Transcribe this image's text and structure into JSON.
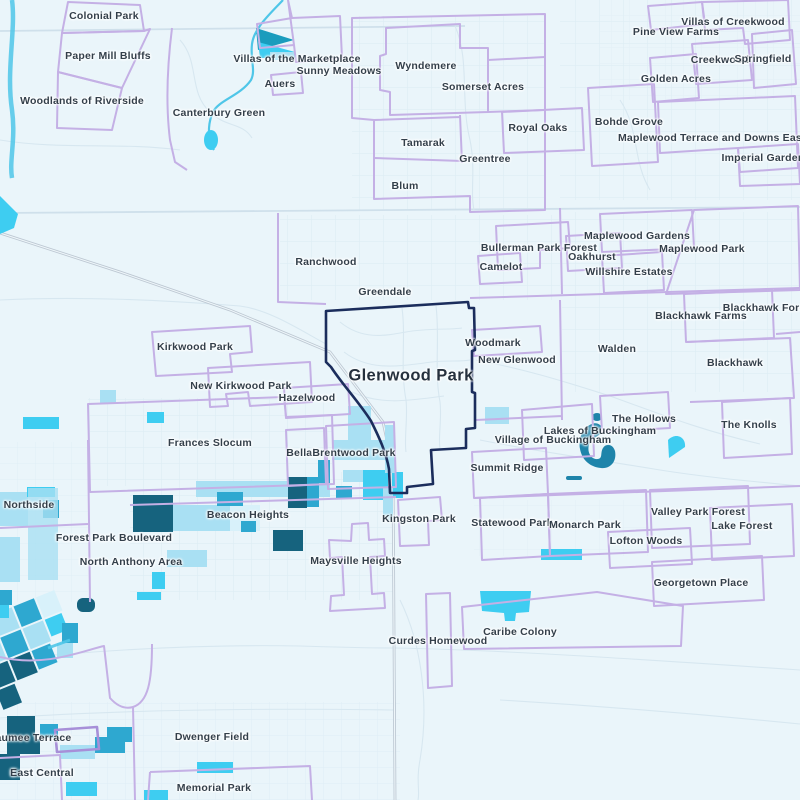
{
  "map": {
    "type": "neighborhood-boundary-map",
    "highlighted_neighborhood": "Glenwood Park",
    "palette": {
      "bg": "#eaf5fa",
      "boundary": "#c4b0e5",
      "boundaryStrong": "#a78fd8",
      "selected": "#1b2d5c",
      "c1": "#d8f1fa",
      "c2": "#a9e0f3",
      "c3": "#2ea8d0",
      "c4": "#3ecdf1",
      "c5": "#16637e",
      "lake": "#1e84aa",
      "river": "#4fc6e8"
    },
    "labels": [
      {
        "text": "Colonial Park",
        "x": 104,
        "y": 16
      },
      {
        "text": "Paper Mill Bluffs",
        "x": 108,
        "y": 56
      },
      {
        "text": "Woodlands of Riverside",
        "x": 82,
        "y": 101
      },
      {
        "text": "Canterbury Green",
        "x": 219,
        "y": 113
      },
      {
        "text": "Villas of the Marketplace",
        "x": 297,
        "y": 59
      },
      {
        "text": "Sunny Meadows",
        "x": 339,
        "y": 71
      },
      {
        "text": "Auers",
        "x": 280,
        "y": 84
      },
      {
        "text": "Wyndemere",
        "x": 426,
        "y": 66
      },
      {
        "text": "Somerset Acres",
        "x": 483,
        "y": 87
      },
      {
        "text": "Royal Oaks",
        "x": 538,
        "y": 128
      },
      {
        "text": "Tamarak",
        "x": 423,
        "y": 143
      },
      {
        "text": "Greentree",
        "x": 485,
        "y": 159
      },
      {
        "text": "Blum",
        "x": 405,
        "y": 186
      },
      {
        "text": "Pine View Farms",
        "x": 676,
        "y": 32
      },
      {
        "text": "Villas of Creekwood",
        "x": 733,
        "y": 22
      },
      {
        "text": "Creekwood",
        "x": 720,
        "y": 60
      },
      {
        "text": "Springfield",
        "x": 763,
        "y": 59
      },
      {
        "text": "Golden Acres",
        "x": 676,
        "y": 79
      },
      {
        "text": "Bohde Grove",
        "x": 629,
        "y": 122
      },
      {
        "text": "Maplewood Terrace and Downs Eastgate",
        "x": 723,
        "y": 138
      },
      {
        "text": "Imperial Gardens",
        "x": 766,
        "y": 158
      },
      {
        "text": "Maplewood Gardens",
        "x": 637,
        "y": 236
      },
      {
        "text": "Maplewood Park",
        "x": 702,
        "y": 249
      },
      {
        "text": "Bullerman Park Forest",
        "x": 539,
        "y": 248
      },
      {
        "text": "Oakhurst",
        "x": 592,
        "y": 257
      },
      {
        "text": "Camelot",
        "x": 501,
        "y": 267
      },
      {
        "text": "Willshire Estates",
        "x": 629,
        "y": 272
      },
      {
        "text": "Ranchwood",
        "x": 326,
        "y": 262
      },
      {
        "text": "Greendale",
        "x": 385,
        "y": 292
      },
      {
        "text": "Blackhawk Forest",
        "x": 769,
        "y": 308
      },
      {
        "text": "Blackhawk Farms",
        "x": 701,
        "y": 316
      },
      {
        "text": "Walden",
        "x": 617,
        "y": 349
      },
      {
        "text": "Blackhawk",
        "x": 735,
        "y": 363
      },
      {
        "text": "Woodmark",
        "x": 493,
        "y": 343
      },
      {
        "text": "New Glenwood",
        "x": 517,
        "y": 360
      },
      {
        "text": "Glenwood Park",
        "x": 411,
        "y": 376,
        "big": true
      },
      {
        "text": "Kirkwood Park",
        "x": 195,
        "y": 347
      },
      {
        "text": "New Kirkwood Park",
        "x": 241,
        "y": 386
      },
      {
        "text": "Hazelwood",
        "x": 307,
        "y": 398
      },
      {
        "text": "Frances Slocum",
        "x": 210,
        "y": 443
      },
      {
        "text": "Bellair",
        "x": 303,
        "y": 453
      },
      {
        "text": "Brentwood Park",
        "x": 354,
        "y": 453
      },
      {
        "text": "The Hollows",
        "x": 644,
        "y": 419
      },
      {
        "text": "Lakes of Buckingham",
        "x": 600,
        "y": 431
      },
      {
        "text": "Village of Buckingham",
        "x": 553,
        "y": 440
      },
      {
        "text": "The Knolls",
        "x": 749,
        "y": 425
      },
      {
        "text": "Summit Ridge",
        "x": 507,
        "y": 468
      },
      {
        "text": "Northside",
        "x": 29,
        "y": 505
      },
      {
        "text": "Beacon Heights",
        "x": 248,
        "y": 515
      },
      {
        "text": "Forest Park Boulevard",
        "x": 114,
        "y": 538
      },
      {
        "text": "North Anthony Area",
        "x": 131,
        "y": 562
      },
      {
        "text": "Kingston Park",
        "x": 419,
        "y": 519
      },
      {
        "text": "Maysville Heights",
        "x": 356,
        "y": 561
      },
      {
        "text": "Statewood Park",
        "x": 512,
        "y": 523
      },
      {
        "text": "Monarch Park",
        "x": 585,
        "y": 525
      },
      {
        "text": "Valley Park Forest",
        "x": 698,
        "y": 512
      },
      {
        "text": "Lake Forest",
        "x": 742,
        "y": 526
      },
      {
        "text": "Lofton Woods",
        "x": 646,
        "y": 541
      },
      {
        "text": "Georgetown Place",
        "x": 701,
        "y": 583
      },
      {
        "text": "Curdes Homewood",
        "x": 438,
        "y": 641
      },
      {
        "text": "Caribe Colony",
        "x": 520,
        "y": 632
      },
      {
        "text": "Maumee Terrace",
        "x": 29,
        "y": 738
      },
      {
        "text": "East Central",
        "x": 42,
        "y": 773
      },
      {
        "text": "Dwenger Field",
        "x": 212,
        "y": 737
      },
      {
        "text": "Memorial Park",
        "x": 214,
        "y": 788
      }
    ]
  }
}
